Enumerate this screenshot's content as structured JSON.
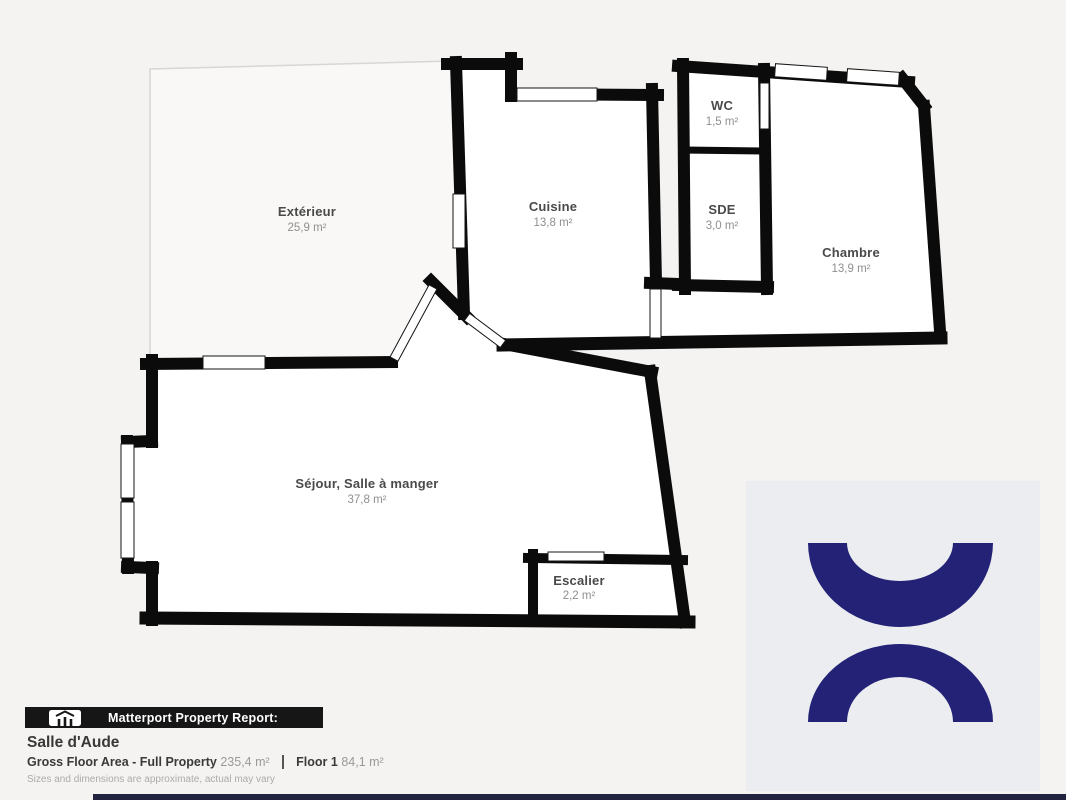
{
  "floorplan": {
    "wall_color": "#0b0b0b",
    "rooms": [
      {
        "id": "exterieur",
        "name": "Extérieur",
        "area": "25,9 m²"
      },
      {
        "id": "cuisine",
        "name": "Cuisine",
        "area": "13,8 m²"
      },
      {
        "id": "wc",
        "name": "WC",
        "area": "1,5 m²"
      },
      {
        "id": "sde",
        "name": "SDE",
        "area": "3,0 m²"
      },
      {
        "id": "chambre",
        "name": "Chambre",
        "area": "13,9 m²"
      },
      {
        "id": "sejour",
        "name": "Séjour, Salle à manger",
        "area": "37,8 m²"
      },
      {
        "id": "escalier",
        "name": "Escalier",
        "area": "2,2 m²"
      }
    ]
  },
  "footer": {
    "report_label": "Matterport Property Report:",
    "title": "Salle d'Aude",
    "gross_label": "Gross Floor Area - Full Property",
    "gross_value": "235,4 m²",
    "floor_label": "Floor 1",
    "floor_value": "84,1 m²",
    "disclaimer": "Sizes and dimensions are approximate, actual may vary"
  },
  "logo": {
    "icon": "matterport-arcs-logo",
    "color": "#232276",
    "background": "#ecedf0"
  }
}
